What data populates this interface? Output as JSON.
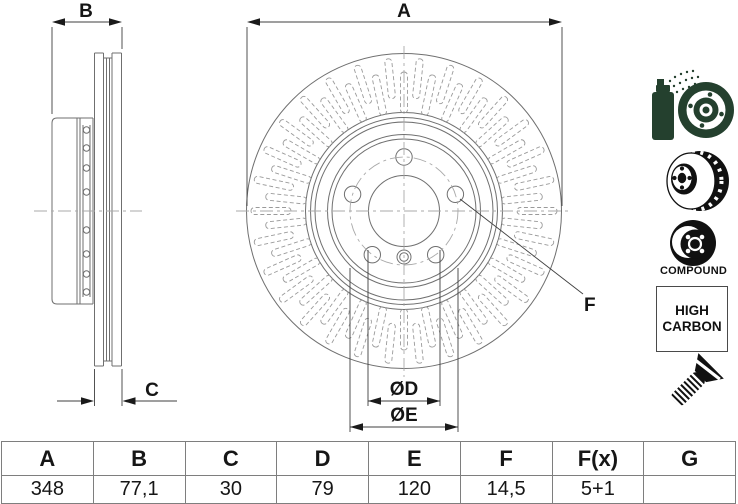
{
  "drawing": {
    "labels": {
      "a": "A",
      "b": "B",
      "c": "C",
      "d": "ØD",
      "e": "ØE",
      "f": "F"
    }
  },
  "badges": {
    "compound": "COMPOUND",
    "high_carbon": [
      "HIGH",
      "CARBON"
    ]
  },
  "table": {
    "headers": [
      "A",
      "B",
      "C",
      "D",
      "E",
      "F",
      "F(x)",
      "G"
    ],
    "values": [
      "348",
      "77,1",
      "30",
      "79",
      "120",
      "14,5",
      "5+1",
      ""
    ]
  },
  "colors": {
    "icon_green": "#24402e",
    "icon_black": "#111111",
    "line_gray": "#6f6f6f"
  }
}
